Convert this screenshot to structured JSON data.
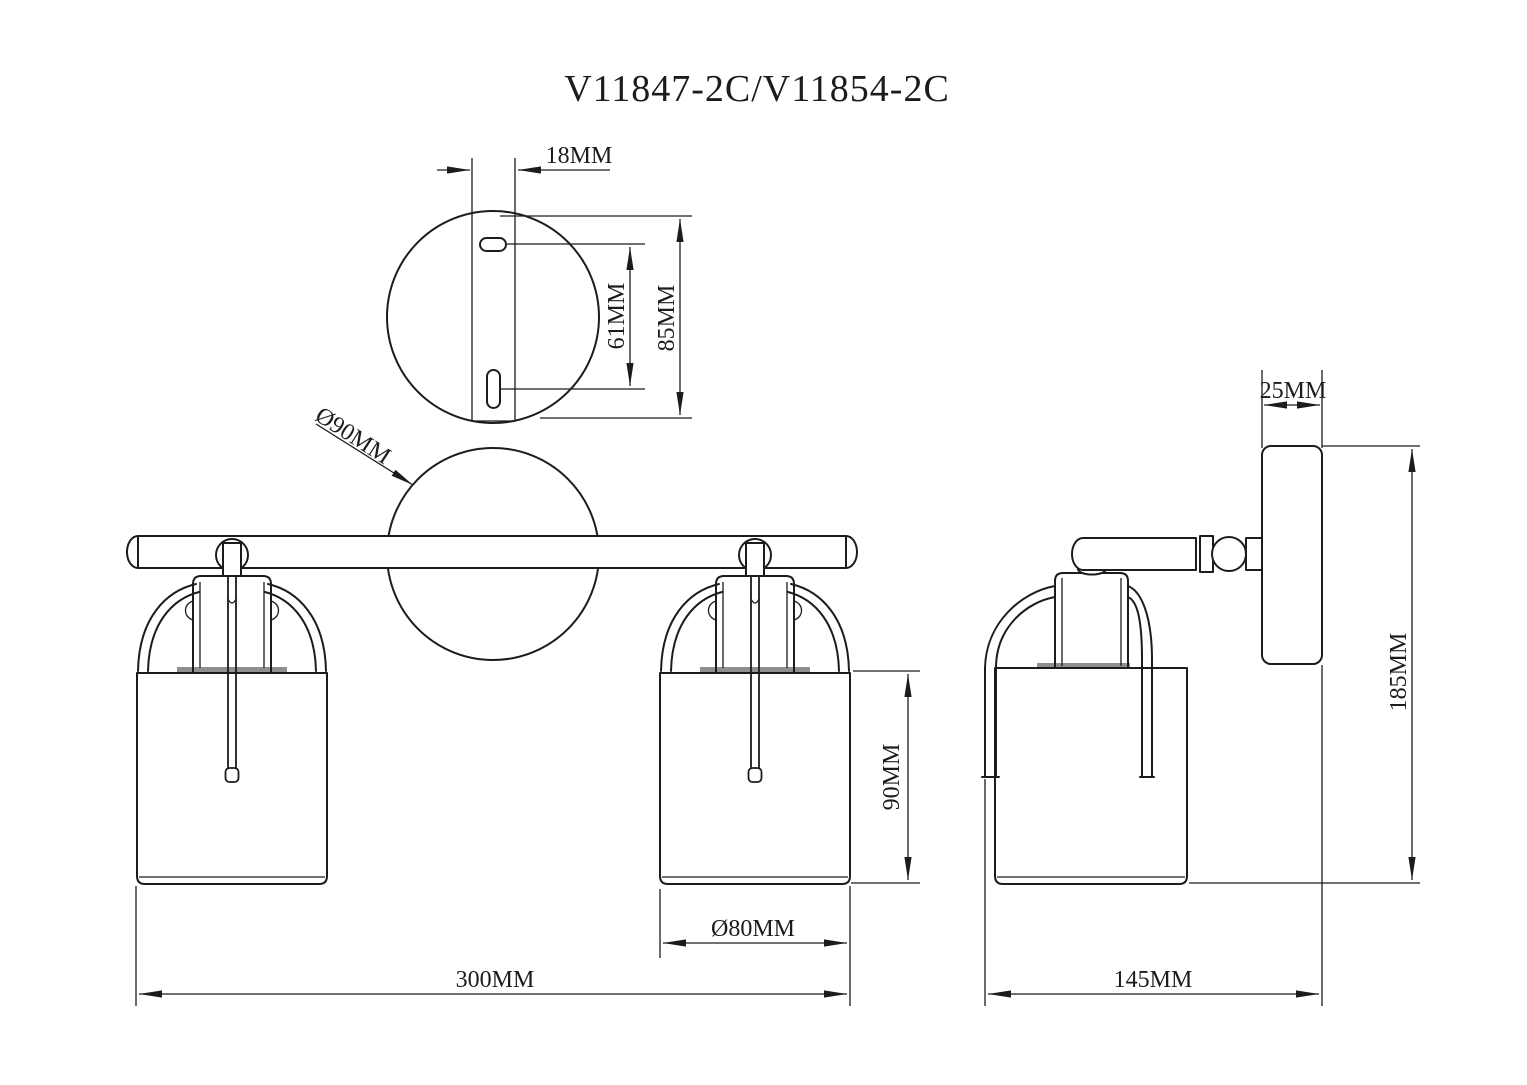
{
  "title": "V11847-2C/V11854-2C",
  "colors": {
    "line": "#1c1c1c",
    "background": "#ffffff",
    "shade_rim": "#8f8f8f"
  },
  "views": {
    "top": {
      "dims": {
        "strip_width": "18MM",
        "slot_spacing": "61MM",
        "plate_height": "85MM"
      }
    },
    "front": {
      "dims": {
        "backplate_diameter": "Ø90MM",
        "shade_height": "90MM",
        "shade_diameter": "Ø80MM",
        "overall_width": "300MM"
      }
    },
    "side": {
      "dims": {
        "backplate_depth": "25MM",
        "overall_height": "185MM",
        "overall_depth": "145MM"
      }
    }
  }
}
